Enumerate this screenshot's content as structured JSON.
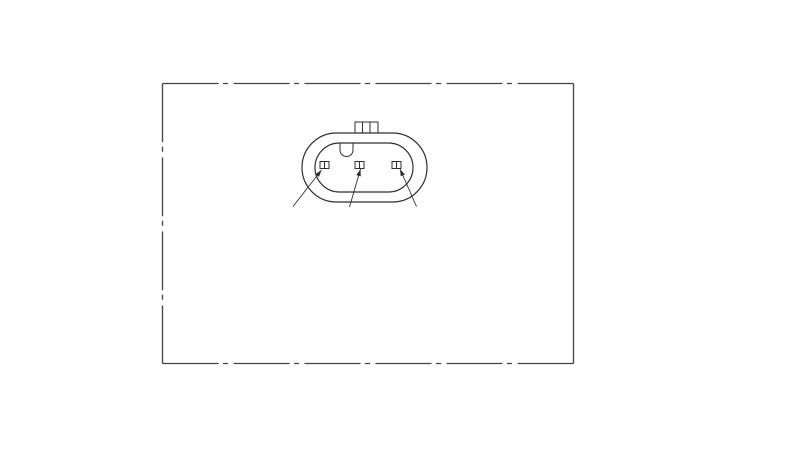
{
  "canvas": {
    "width": 800,
    "height": 451,
    "background_color": "#ffffff"
  },
  "drawing": {
    "stroke_colors": {
      "border": "#424242",
      "connector": "#2f2f2f"
    },
    "stroke_widths": {
      "border": 1.3,
      "outline": 1.2,
      "detail": 1.0,
      "leader": 0.9
    },
    "border": {
      "x": 162.5,
      "y": 83.5,
      "width": 411,
      "height": 280,
      "style": "phantom",
      "dash_horizontal": "56 4.5 5 5.5",
      "dash_left": "58.75 4.5 5 5.75",
      "dash_right": "none"
    },
    "connector": {
      "outer_body": {
        "x": 302,
        "y": 133,
        "w": 125,
        "h": 69,
        "r": 34.5
      },
      "inner_body": {
        "x": 315,
        "y": 143,
        "w": 98,
        "h": 49,
        "r": 24.5
      },
      "latch_tab": {
        "x": 355,
        "y": 122,
        "w": 23,
        "h": 11,
        "dividers_x": [
          362.5,
          370
        ]
      },
      "keying_notch": {
        "left_x": 340,
        "right_x": 353,
        "top_y": 143.5,
        "straight_bottom_y": 150,
        "radius": 6.5
      },
      "pins": [
        {
          "x": 320,
          "y": 161.5,
          "w": 9,
          "h": 7
        },
        {
          "x": 355,
          "y": 161.5,
          "w": 9,
          "h": 7
        },
        {
          "x": 392,
          "y": 161.5,
          "w": 9,
          "h": 7
        }
      ],
      "leaders": [
        {
          "tail_x": 293,
          "tail_y": 206.5,
          "tip_x": 321.5,
          "tip_y": 170
        },
        {
          "tail_x": 349.5,
          "tail_y": 207,
          "tip_x": 360.5,
          "tip_y": 169
        },
        {
          "tail_x": 416.5,
          "tail_y": 206.5,
          "tip_x": 400,
          "tip_y": 169
        }
      ],
      "arrowhead": {
        "length": 7,
        "half_width": 2.3
      }
    }
  }
}
